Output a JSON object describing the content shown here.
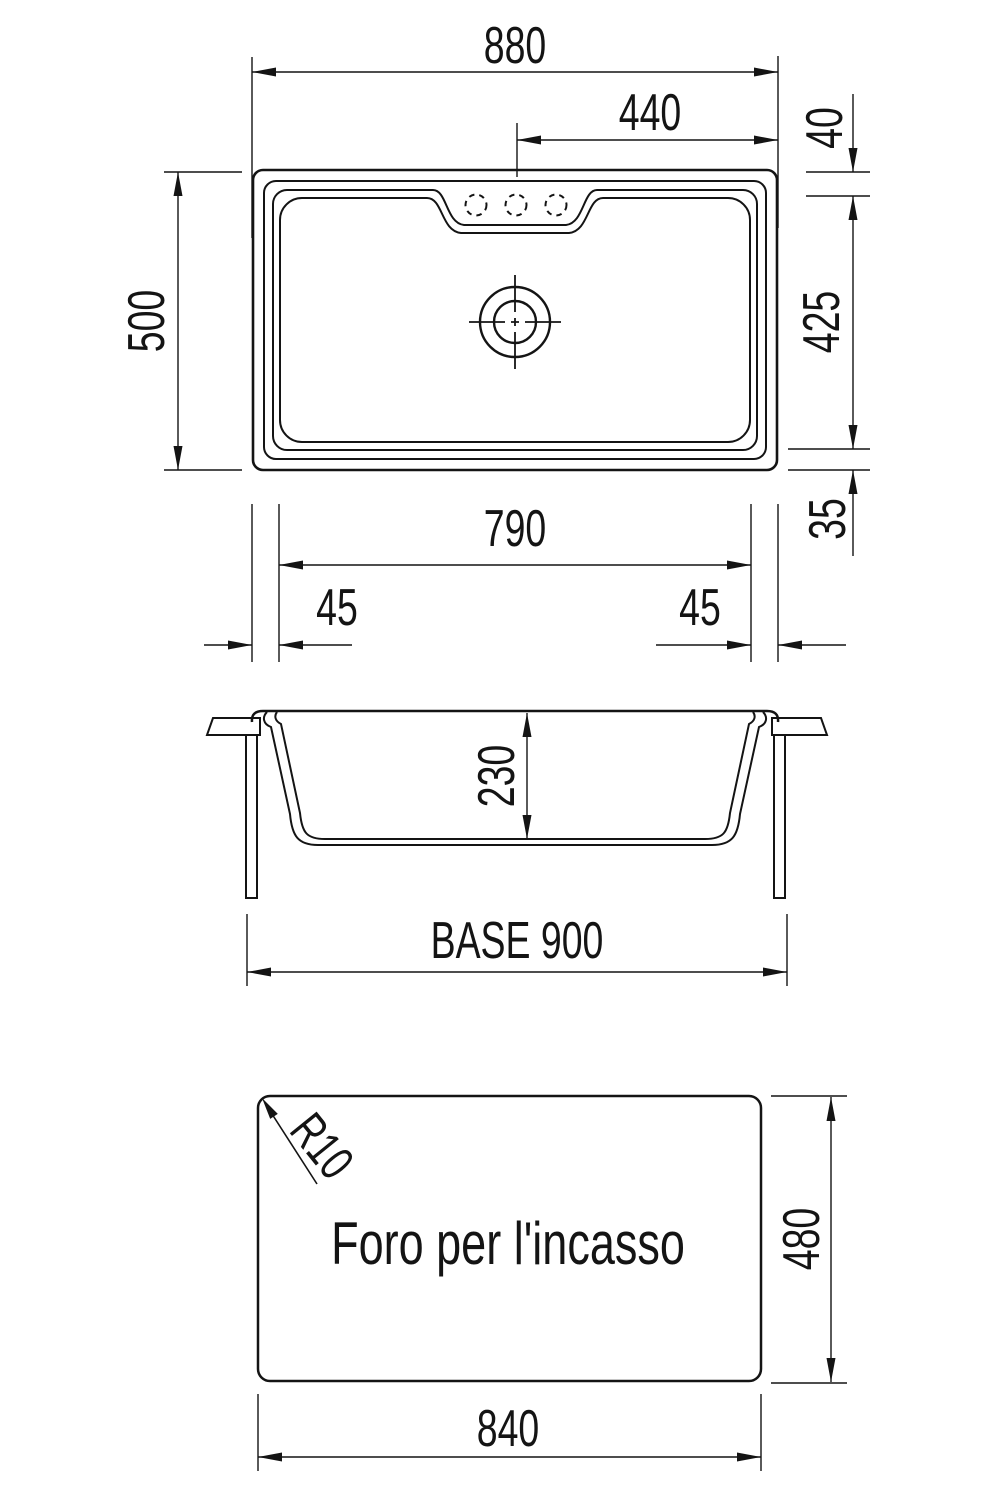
{
  "drawing": {
    "background": "#ffffff",
    "line_color": "#141414"
  },
  "top_view": {
    "dims": {
      "width_overall": "880",
      "width_center_to_edge": "440",
      "rim_to_faucet_line": "40",
      "depth_overall": "500",
      "bowl_depth": "425",
      "bowl_to_bottom_edge": "35",
      "bowl_width": "790",
      "edge_left": "45",
      "edge_right": "45"
    }
  },
  "side_view": {
    "dims": {
      "bowl_height": "230",
      "base_width": "BASE 900"
    }
  },
  "cutout_view": {
    "label": "Foro per l'incasso",
    "dims": {
      "corner_radius": "R10",
      "cutout_height": "480",
      "cutout_width": "840"
    }
  }
}
